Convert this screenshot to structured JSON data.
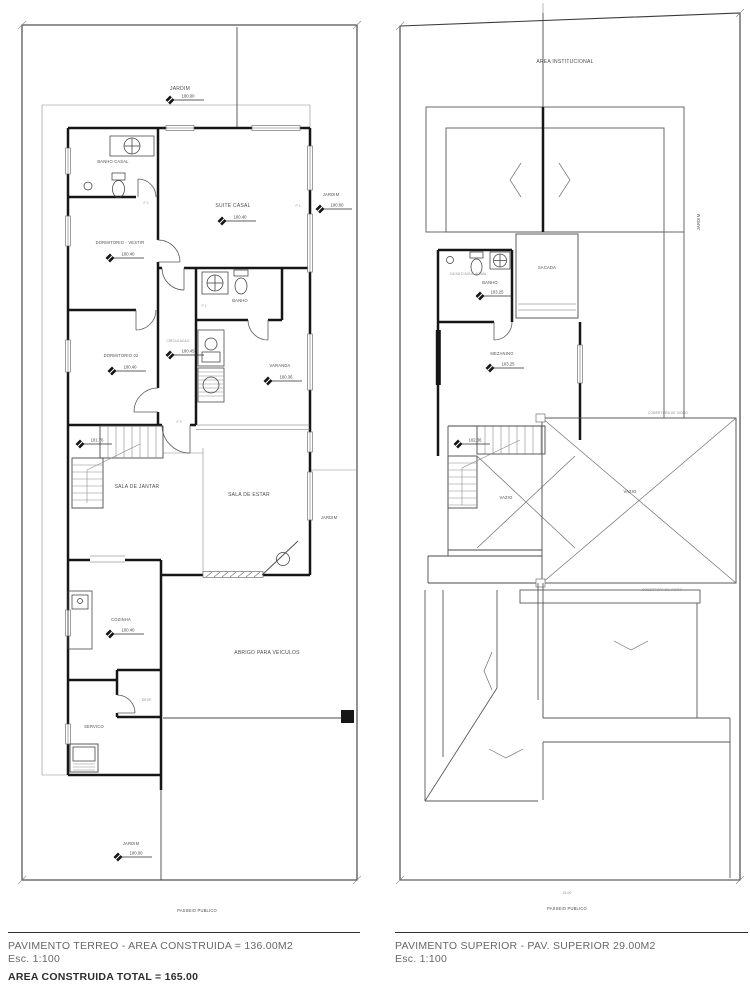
{
  "colors": {
    "wall": "#161616",
    "thin_line": "#8a8a8a",
    "text": "#4c4c4c",
    "paper": "#ffffff"
  },
  "ground_floor": {
    "rooms": {
      "jardim_top": {
        "name": "JARDIM",
        "level": "100.00"
      },
      "banho_casal": {
        "name": "BANHO CASAL"
      },
      "suite_casal": {
        "name": "SUITE CASAL",
        "level": "100.40"
      },
      "jardim_right": {
        "name": "JARDIM",
        "level": "100.00"
      },
      "dormitorio_vestir": {
        "name": "DORMITORIO - VESTIR",
        "level": "100.40"
      },
      "banho": {
        "name": "BANHO"
      },
      "dormitorio_02": {
        "name": "DORMITORIO 02",
        "level": "100.40"
      },
      "circulacao": {
        "name": "CIRCULACAO",
        "level": "100.45"
      },
      "varanda": {
        "name": "VARANDA",
        "level": "100.36"
      },
      "escada": {
        "level": "101.76"
      },
      "sala_jantar": {
        "name": "SALA DE JANTAR"
      },
      "sala_estar": {
        "name": "SALA DE ESTAR"
      },
      "jardim_mid": {
        "name": "JARDIM"
      },
      "cozinha": {
        "name": "COZINHA",
        "level": "100.40"
      },
      "abrigo": {
        "name": "ABRIGO PARA VEICULOS"
      },
      "desp": {
        "name": "DESP."
      },
      "servico": {
        "name": "SERVICO"
      },
      "jardim_bottom": {
        "name": "JARDIM",
        "level": "100.00"
      }
    },
    "door_tags": [
      "P 1",
      "P 2",
      "P 3",
      "P 4"
    ],
    "passeio": "PASSEIO PUBLICO"
  },
  "upper_floor": {
    "rooms": {
      "area_institucional": {
        "name": "AREA INSTITUCIONAL"
      },
      "jardim_side": {
        "name": "JARDIM"
      },
      "caixa_dagua": {
        "name": "CAIXA D'AGUA ACIMA"
      },
      "banho": {
        "name": "BANHO",
        "level": "103.25"
      },
      "sacada": {
        "name": "SACADA"
      },
      "mezanino": {
        "name": "MEZANINO",
        "level": "103.25"
      },
      "escada": {
        "level": "102.36"
      },
      "vazio_esq": {
        "name": "VAZIO"
      },
      "vazio_dir": {
        "name": "VAZIO"
      },
      "cobertura_1": {
        "name": "COBERTURA DE VIDRO"
      },
      "cobertura_2": {
        "name": "COBERTURA DE VIDRO"
      }
    },
    "dim_frente": "15.00",
    "passeio": "PASSEIO PUBLICO"
  },
  "captions": {
    "left_title": "PAVIMENTO TERREO - AREA CONSTRUIDA = 136.00M2",
    "left_scale": "Esc. 1:100",
    "right_title": "PAVIMENTO SUPERIOR - PAV. SUPERIOR 29.00M2",
    "right_scale": "Esc. 1:100",
    "total": "AREA CONSTRUIDA TOTAL = 165.00"
  }
}
